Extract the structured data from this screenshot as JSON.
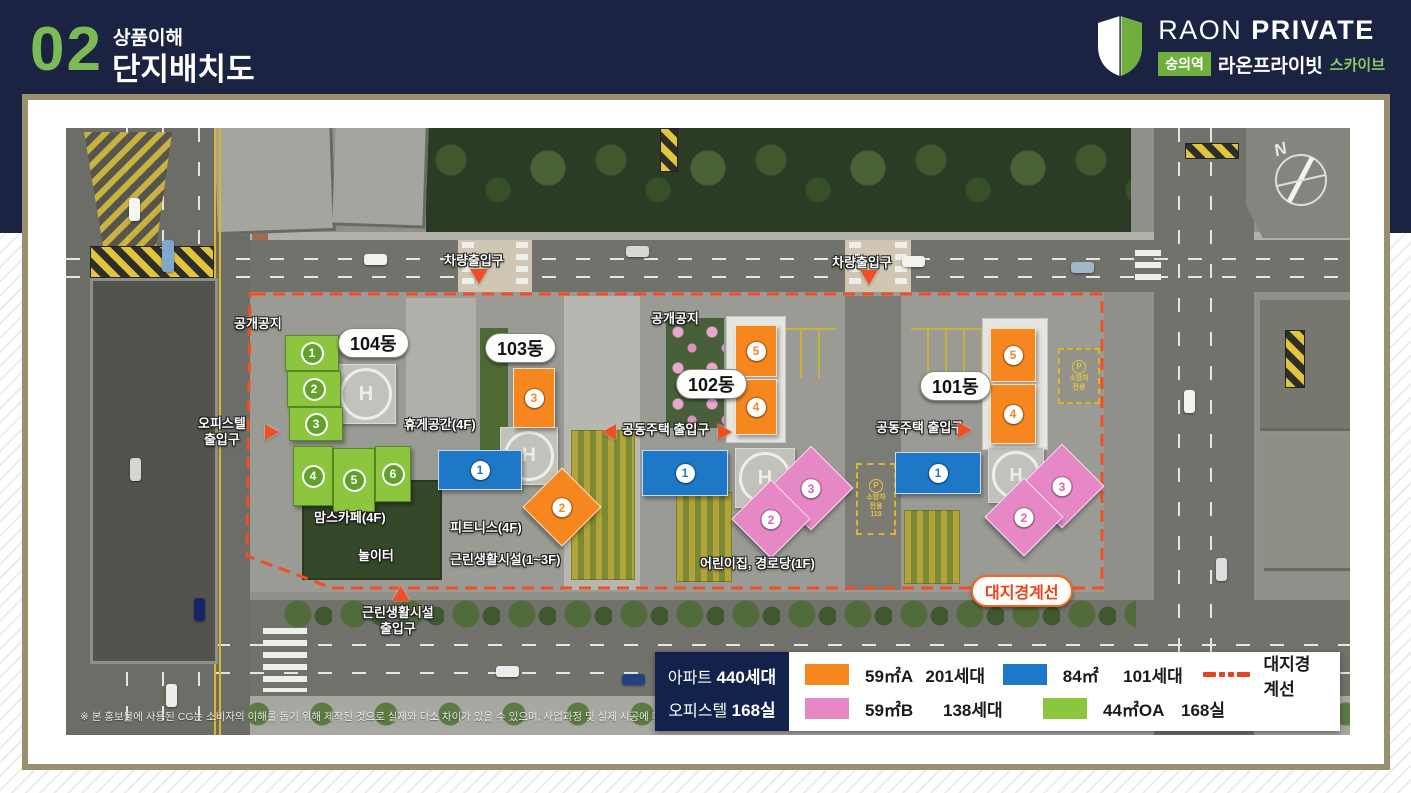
{
  "slide": {
    "number": "02",
    "category": "상품이해",
    "title": "단지배치도"
  },
  "logo": {
    "brand_en_1": "RAON",
    "brand_en_2": "PRIVATE",
    "station": "숭의역",
    "brand_kr": "라온프라이빗",
    "suffix_kr": "스카이브"
  },
  "map": {
    "compass": "N",
    "helipad_mark": "H",
    "buildings": {
      "b101": {
        "name": "101동",
        "units": [
          "1",
          "2",
          "3",
          "4",
          "5"
        ]
      },
      "b102": {
        "name": "102동",
        "units": [
          "1",
          "2",
          "3",
          "4",
          "5"
        ]
      },
      "b103": {
        "name": "103동",
        "units": [
          "1",
          "2",
          "3"
        ]
      },
      "b104": {
        "name": "104동",
        "units": [
          "1",
          "2",
          "3",
          "4",
          "5",
          "6"
        ]
      }
    },
    "labels": {
      "open_space": "공개공지",
      "vehicle_entrance": "차량출입구",
      "officetel_entrance": [
        "오피스텔",
        "출입구"
      ],
      "apartment_entrance": "공동주택 출입구",
      "neighborhood_entrance": [
        "근린생활시설",
        "출입구"
      ],
      "rest_area": "휴게공간(4F)",
      "moms_cafe": "맘스카페(4F)",
      "playground": "놀이터",
      "fitness": "피트니스(4F)",
      "neighborhood_facility": "근린생활시설(1~3F)",
      "daycare_senior": "어린이집, 경로당(1F)",
      "boundary": "대지경계선",
      "fire_lane_p": "P",
      "fire_lane_1": "소방차",
      "fire_lane_2": "전용",
      "fire_lane_119": "119"
    }
  },
  "legend": {
    "summary": [
      {
        "label": "아파트",
        "value": "440세대"
      },
      {
        "label": "오피스텔",
        "value": "168실"
      }
    ],
    "items": [
      {
        "type": "59㎡A",
        "count": "201세대",
        "color": "#F6871F"
      },
      {
        "type": "59㎡B",
        "count": "138세대",
        "color": "#E788C6"
      },
      {
        "type": "84㎡",
        "count": "101세대",
        "color": "#1E78C8"
      },
      {
        "type": "44㎡OA",
        "count": "168실",
        "color": "#8CC63E"
      }
    ],
    "boundary_label": "대지경계선"
  },
  "disclaimer": "※ 본 홍보물에 사용된 CG는 소비자의 이해를 돕기 위해 제작된 것으로 실제와 다소 차이가 있을 수 있으며, 사업과정 및 실제 시공에 따라 변경될 수 있습니다.",
  "colors": {
    "header_navy": "#1B2342",
    "accent_green": "#7DB954",
    "logo_green": "#6FAE3F",
    "card_border": "#9A9070",
    "boundary_line": "#F04E23",
    "unit_59A": "#F6871F",
    "unit_59B": "#E788C6",
    "unit_84": "#1E78C8",
    "unit_44OA": "#8CC63E",
    "legend_navy": "#13224B"
  }
}
